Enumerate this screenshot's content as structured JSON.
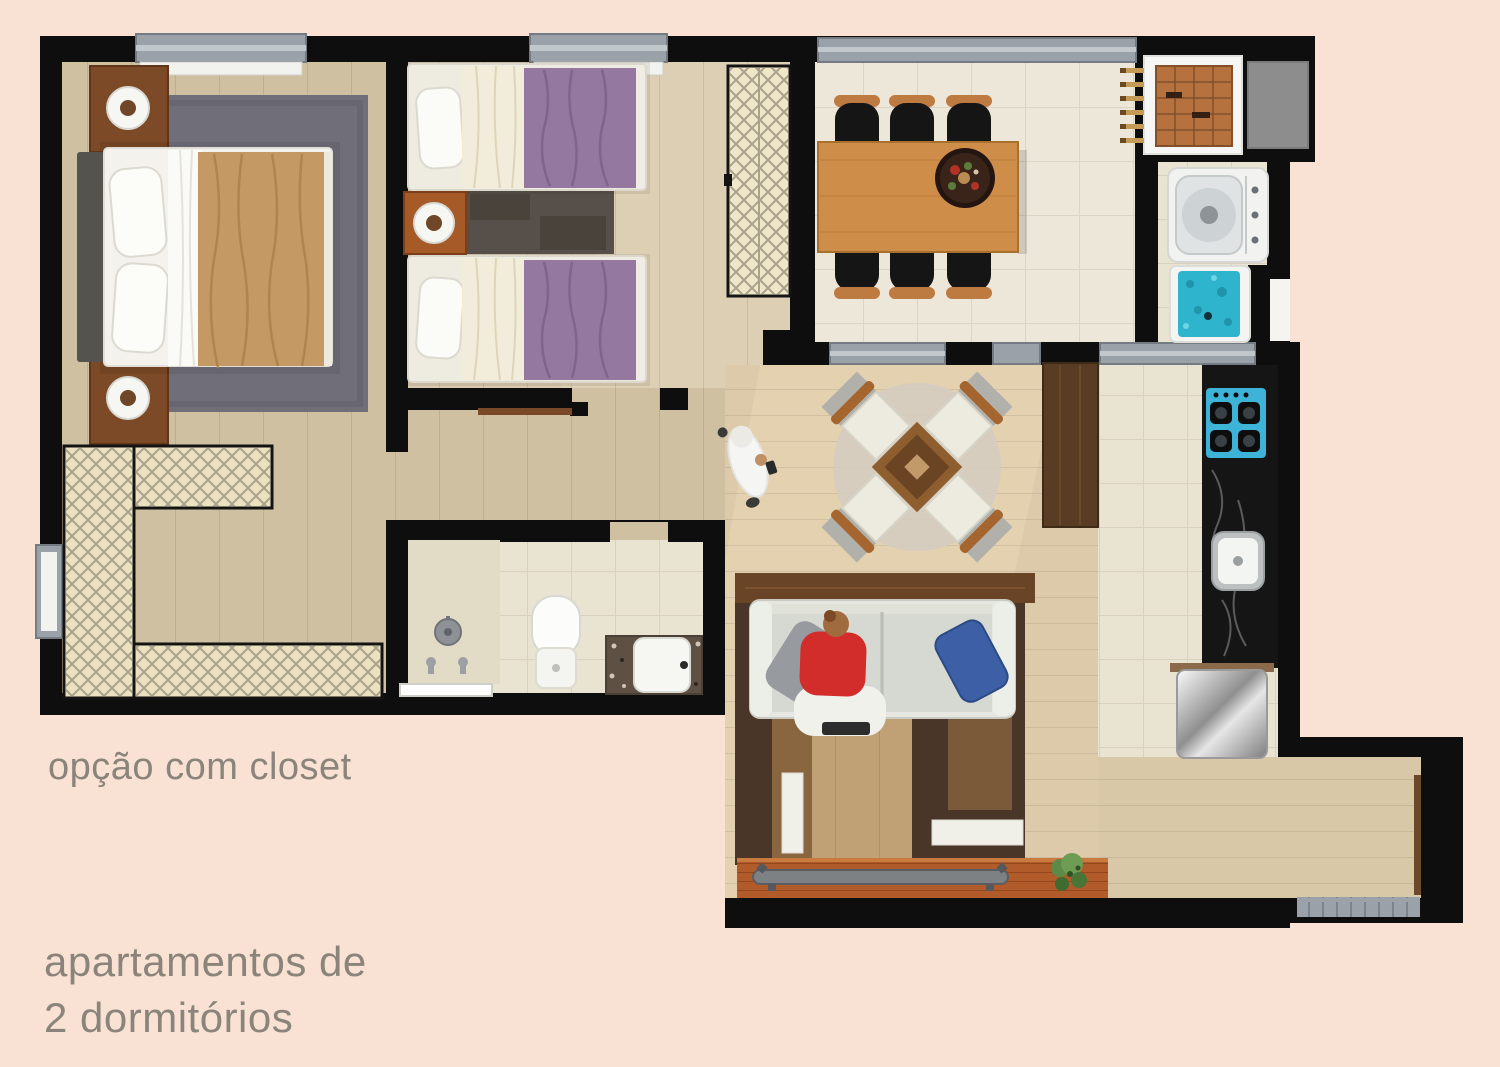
{
  "captions": {
    "closet_option": "opção com closet",
    "apartment_type_line1": "apartamentos de",
    "apartment_type_line2": "2 dormitórios"
  },
  "palette": {
    "background": "#f9e2d3",
    "wall_black": "#0e0e0e",
    "caption_text": "#8a847b",
    "window_gray": "#9aa1a8",
    "master_floor_tan": "#cec0a1",
    "bedroom2_floor": "#d7c9ad",
    "living_floor": "#dccaaa",
    "tile_beige": "#e9e3d1",
    "master_blanket_tan": "#c49963",
    "twin_blanket_purple": "#95789f",
    "dining_table_wood": "#ce8d49",
    "kitchen_counter_black": "#151515",
    "cooktop_blue": "#3db3d8",
    "laundry_tank_blue": "#2eb5cd",
    "sofa_pillow_blue": "#3c5fa6",
    "sitting_person_red": "#d22c2b",
    "deck_terracotta": "#b15a2a",
    "plant_green": "#5d8a46"
  },
  "floorplan": {
    "rooms": [
      {
        "id": "master-bedroom"
      },
      {
        "id": "second-bedroom"
      },
      {
        "id": "walk-in-closet"
      },
      {
        "id": "bathroom"
      },
      {
        "id": "hallway"
      },
      {
        "id": "dining-room"
      },
      {
        "id": "service-area"
      },
      {
        "id": "kitchen"
      },
      {
        "id": "living-room"
      },
      {
        "id": "balcony-deck"
      }
    ],
    "furniture": [
      "double-bed",
      "twin-bed",
      "nightstand-lamp",
      "closet-shelving",
      "wardrobe",
      "shower",
      "toilet",
      "vanity-sink",
      "dining-table",
      "dining-chair",
      "drying-rack",
      "washing-machine",
      "laundry-tank",
      "cooktop",
      "kitchen-sink",
      "refrigerator",
      "sofa",
      "round-table-set",
      "bench",
      "plant",
      "person-figure"
    ]
  }
}
